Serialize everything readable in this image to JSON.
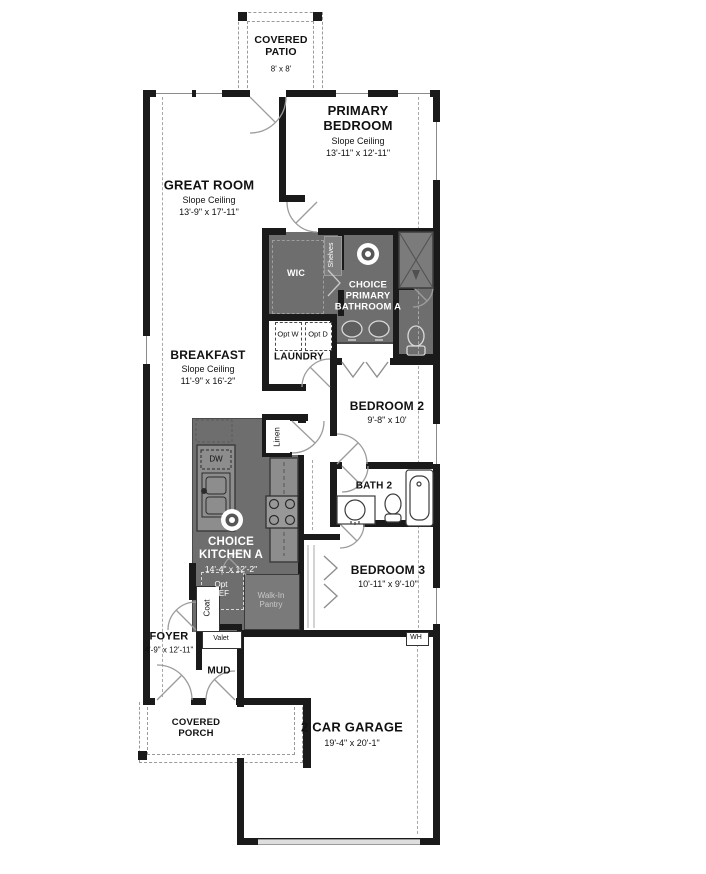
{
  "colors": {
    "wall": "#1a1a1a",
    "choice_room_fill": "#6e6e6e",
    "counter_fill": "#8d8d8d",
    "door_arc": "#9c9c9c",
    "dashed_line": "#a8a8a8",
    "garage_door": "#dedede",
    "label_text": "#111111",
    "label_text_inverse": "#ffffff"
  },
  "icons": {
    "choice_marker": "bullseye"
  },
  "rooms": {
    "covered_patio": {
      "name": "COVERED PATIO",
      "dims": "8' x 8'"
    },
    "great_room": {
      "name": "GREAT ROOM",
      "ceiling": "Slope Ceiling",
      "dims": "13'-9\" x 17'-11\""
    },
    "primary_bedroom": {
      "name": "PRIMARY BEDROOM",
      "ceiling": "Slope Ceiling",
      "dims": "13'-11\" x 12'-11\""
    },
    "wic": {
      "name": "WIC",
      "shelves": "Shelves"
    },
    "choice_primary_bathroom": {
      "name": "CHOICE PRIMARY BATHROOM A"
    },
    "breakfast": {
      "name": "BREAKFAST",
      "ceiling": "Slope Ceiling",
      "dims": "11'-9\" x 16'-2\""
    },
    "laundry": {
      "name": "LAUNDRY",
      "opt_washer": "Opt W",
      "opt_dryer": "Opt D"
    },
    "bedroom_2": {
      "name": "BEDROOM 2",
      "dims": "9'-8\" x 10'"
    },
    "linen": {
      "name": "Linen"
    },
    "bath_2": {
      "name": "BATH 2"
    },
    "choice_kitchen": {
      "name": "CHOICE KITCHEN A",
      "dims": "14'-4\" x 12'-2\"",
      "dishwasher": "DW",
      "opt_refrigerator": "Opt REF",
      "pantry": "Walk-In Pantry"
    },
    "coat": {
      "name": "Coat"
    },
    "bedroom_3": {
      "name": "BEDROOM 3",
      "dims": "10'-11\" x 9'-10\""
    },
    "foyer": {
      "name": "FOYER",
      "dims": "4'-9\" x 12'-11\"",
      "valet": "Valet"
    },
    "mud": {
      "name": "MUD"
    },
    "water_heater": {
      "name": "WH"
    },
    "covered_porch": {
      "name": "COVERED PORCH"
    },
    "garage": {
      "name": "2 CAR GARAGE",
      "dims": "19'-4\" x 20'-1\""
    }
  }
}
